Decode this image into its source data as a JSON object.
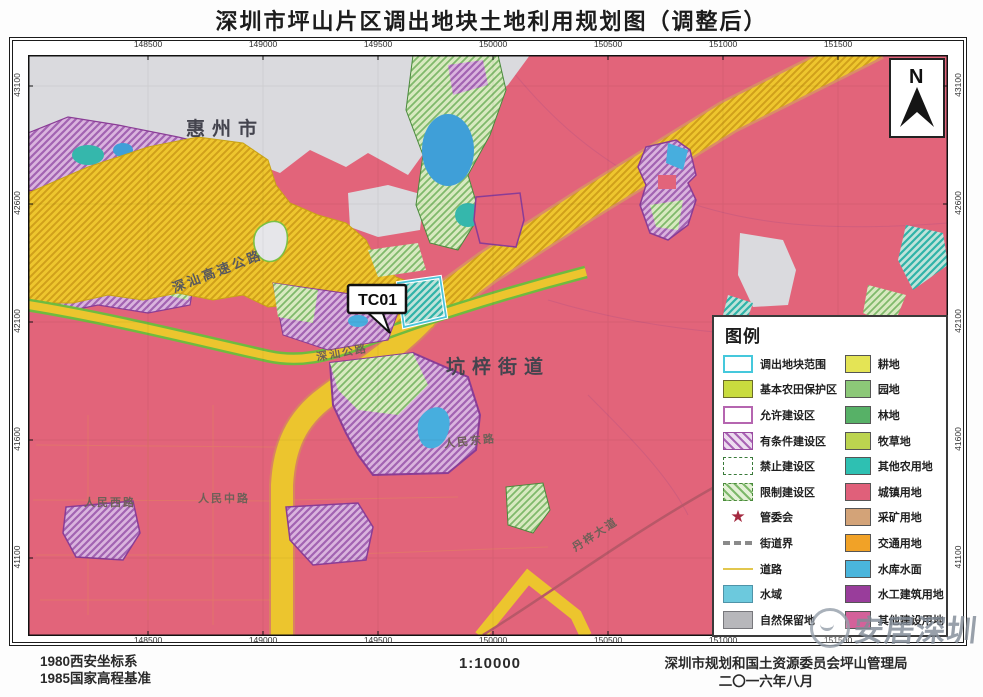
{
  "title": "深圳市坪山片区调出地块土地利用规划图（调整后）",
  "map": {
    "x_ticks": [
      "148500",
      "149000",
      "149500",
      "150000",
      "150500",
      "151000",
      "151500"
    ],
    "y_ticks": [
      "43100",
      "42600",
      "42100",
      "41600",
      "41100"
    ],
    "labels": {
      "city": "惠州市",
      "street": "坑梓街道",
      "highway": "深汕高速公路",
      "road_shenshan": "深汕公路",
      "road_renmin_west": "人民西路",
      "road_renmin_mid": "人民中路",
      "road_renmin_east": "人民东路",
      "road_danzi": "丹梓大道",
      "callout": "TC01",
      "north": "N"
    },
    "colors": {
      "urban_pink": "#e2647a",
      "outside_gray": "#dadade",
      "farmland_yellow": "#eec62e",
      "road_green_edge": "#6fbb3f"
    }
  },
  "legend": {
    "title": "图例",
    "left_column": [
      {
        "label": "调出地块范围",
        "type": "outline",
        "fill": "#ffffff",
        "border": "#45c8dc"
      },
      {
        "label": "基本农田保护区",
        "type": "fill",
        "fill": "#c9dc3e",
        "border": "#6b6b2a"
      },
      {
        "label": "允许建设区",
        "type": "outline",
        "fill": "#ffffff",
        "border": "#b565b0"
      },
      {
        "label": "有条件建设区",
        "type": "hatch-purple",
        "fill": "#ecdcef",
        "border": "#9a4ba0",
        "line": "#a863b4"
      },
      {
        "label": "禁止建设区",
        "type": "outline-dashed",
        "fill": "#ffffff",
        "border": "#3a7a3a"
      },
      {
        "label": "限制建设区",
        "type": "hatch-green",
        "fill": "#e4f0d6",
        "border": "#4a8a3c",
        "line": "#7db86a"
      },
      {
        "label": "管委会",
        "type": "star",
        "fill": "#a42a40"
      },
      {
        "label": "街道界",
        "type": "line-thick",
        "fill": "#8a8a8a"
      },
      {
        "label": "道路",
        "type": "line-thin",
        "fill": "#e2c74e"
      },
      {
        "label": "水域",
        "type": "fill",
        "fill": "#6cc9dd",
        "border": "#4f93a8"
      },
      {
        "label": "自然保留地",
        "type": "fill",
        "fill": "#b7b7bb",
        "border": "#77777c"
      }
    ],
    "right_column": [
      {
        "label": "耕地",
        "fill": "#e4e455"
      },
      {
        "label": "园地",
        "fill": "#8cc878"
      },
      {
        "label": "林地",
        "fill": "#57b167"
      },
      {
        "label": "牧草地",
        "fill": "#bcd44f"
      },
      {
        "label": "其他农用地",
        "fill": "#2ec0b2"
      },
      {
        "label": "城镇用地",
        "fill": "#e0607a"
      },
      {
        "label": "采矿用地",
        "fill": "#d3a378"
      },
      {
        "label": "交通用地",
        "fill": "#f1a227"
      },
      {
        "label": "水库水面",
        "fill": "#4ab5dc"
      },
      {
        "label": "水工建筑用地",
        "fill": "#993d9b"
      },
      {
        "label": "其他建设用地",
        "fill": "#d4619a"
      }
    ]
  },
  "footer": {
    "datum_line1": "1980西安坐标系",
    "datum_line2": "1985国家高程基准",
    "scale": "1:10000",
    "agency": "深圳市规划和国土资源委员会坪山管理局",
    "date": "二〇一六年八月"
  },
  "watermark": {
    "text": "安居深圳"
  }
}
